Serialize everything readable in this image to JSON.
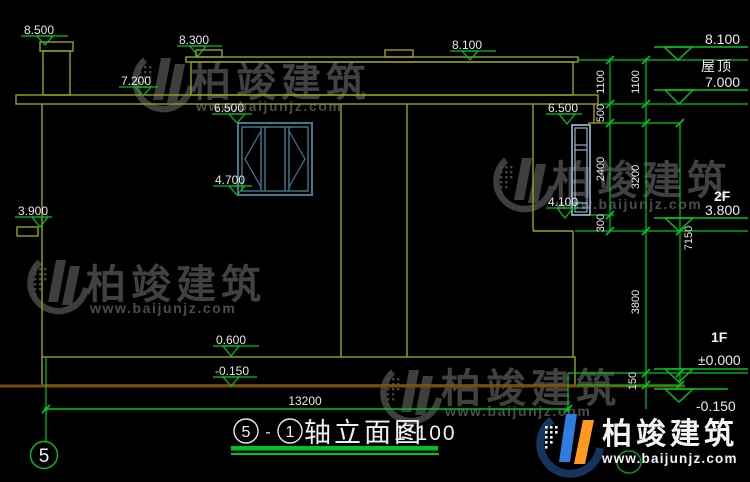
{
  "markers": {
    "m8500": "8.500",
    "m8300": "8.300",
    "m8100_top": "8.100",
    "m7200": "7.200",
    "m6500_left": "6.500",
    "m4700": "4.700",
    "m3900": "3.900",
    "m6500_right": "6.500",
    "m4100": "4.100",
    "m0600": "0.600",
    "m_neg0150": "-0.150"
  },
  "right_panel": {
    "m8100": "8.100",
    "roof_label": "屋顶",
    "m7000": "7.000",
    "floor2_label": "2F",
    "m3800": "3.800",
    "floor1_label": "1F",
    "m_zero": "±0.000",
    "m_neg0150": "-0.150"
  },
  "dims": {
    "d1100_a": "1100",
    "d1100_b": "1100",
    "d500": "500",
    "d2400": "2400",
    "d300": "300",
    "d3200": "3200",
    "d3800": "3800",
    "d150": "150",
    "d7150": "7150",
    "d13200": "13200"
  },
  "title": {
    "axis_start": "5",
    "sep": "-",
    "axis_end": "1",
    "name": "轴立面图",
    "scale": "1:100"
  },
  "axis_bubble": {
    "label": "5"
  },
  "watermark": {
    "brand": "柏竣建筑",
    "url": "www.baijunjz.com"
  },
  "brand_logo": {
    "brand": "柏竣建筑",
    "url": "www.baijunjz.com"
  },
  "colors": {
    "background": "#000000",
    "wall_yellow": "#9aa21c",
    "dim_green": "#00c41e",
    "text_white": "#e8e8e8",
    "window_teal": "#44788c",
    "window_light_blue": "#9cc0dc",
    "ground_brown": "#7a4a14",
    "logo_blue": "#2f7de0",
    "logo_orange": "#ff9a1e",
    "logo_navy": "#16355e",
    "watermark_gray": "#474747"
  }
}
